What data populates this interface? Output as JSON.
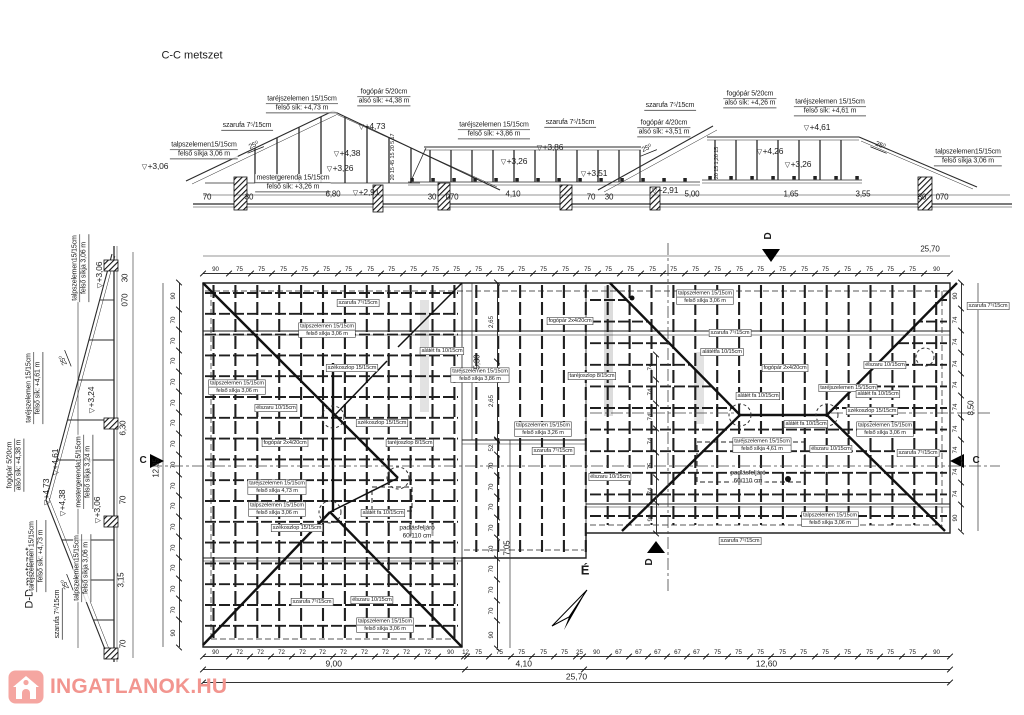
{
  "titles": {
    "section_cc": "C-C metszet",
    "section_dd": "D-D metszet"
  },
  "watermark": {
    "text": "INGATLANOK.HU",
    "color": "#f2958f",
    "icon_bg": "#f5a6a1"
  },
  "north": {
    "label": "É"
  },
  "annotations": [
    {
      "s": "title",
      "t": "C-C metszet",
      "x": 192,
      "y": 56
    },
    {
      "s": "title",
      "t": "D-D metszet",
      "x": 30,
      "y": 578,
      "r": -90
    },
    {
      "s": "u2",
      "t": "taréjszelemen 15/15cm|felső sík: +4,73 m",
      "x": 302,
      "y": 104
    },
    {
      "s": "u2",
      "t": "fogópár 5/20cm|alsó sík: +4,38 m",
      "x": 384,
      "y": 97
    },
    {
      "s": "u1",
      "t": "szarufa 7⁵/15cm",
      "x": 247,
      "y": 126
    },
    {
      "s": "u2",
      "t": "talpszelemen15/15cm|felső síkja 3,06 m",
      "x": 204,
      "y": 150
    },
    {
      "s": "lv",
      "t": "+3,06",
      "x": 155,
      "y": 167
    },
    {
      "s": "lv",
      "t": "+4,73",
      "x": 372,
      "y": 127
    },
    {
      "s": "lv",
      "t": "+4,38",
      "x": 347,
      "y": 154
    },
    {
      "s": "lv",
      "t": "+3,26",
      "x": 340,
      "y": 169
    },
    {
      "s": "u2",
      "t": "mestergerenda 15/15cm|felső sík: +3,26 m",
      "x": 293,
      "y": 183
    },
    {
      "s": "deg",
      "t": "25⁰",
      "x": 254,
      "y": 146,
      "r": -22
    },
    {
      "s": "d",
      "t": "70",
      "x": 207,
      "y": 198
    },
    {
      "s": "d",
      "t": "30",
      "x": 249,
      "y": 198
    },
    {
      "s": "d",
      "t": "6,80",
      "x": 333,
      "y": 195
    },
    {
      "s": "lv",
      "t": "+2,91",
      "x": 366,
      "y": 193
    },
    {
      "s": "d",
      "t": "30",
      "x": 432,
      "y": 198
    },
    {
      "s": "d",
      "t": "070",
      "x": 452,
      "y": 198
    },
    {
      "s": "d",
      "t": "4,10",
      "x": 513,
      "y": 195
    },
    {
      "s": "d",
      "t": "70",
      "x": 591,
      "y": 198
    },
    {
      "s": "d",
      "t": "30",
      "x": 609,
      "y": 198
    },
    {
      "s": "lv",
      "t": "+2,91",
      "x": 665,
      "y": 191
    },
    {
      "s": "d",
      "t": "5,00",
      "x": 692,
      "y": 195
    },
    {
      "s": "d",
      "t": "1,65",
      "x": 791,
      "y": 195
    },
    {
      "s": "d",
      "t": "3,55",
      "x": 863,
      "y": 195
    },
    {
      "s": "d",
      "t": "30",
      "x": 922,
      "y": 198
    },
    {
      "s": "d",
      "t": "070",
      "x": 942,
      "y": 198
    },
    {
      "s": "u2",
      "t": "taréjszelemen 15/15cm|felső sík: +3,86 m",
      "x": 494,
      "y": 130
    },
    {
      "s": "u1",
      "t": "szarufa 7⁵/15cm",
      "x": 570,
      "y": 123
    },
    {
      "s": "lv",
      "t": "+3,86",
      "x": 550,
      "y": 148
    },
    {
      "s": "lv",
      "t": "+3,26",
      "x": 514,
      "y": 162
    },
    {
      "s": "u1",
      "t": "szarufa 7⁵/15cm",
      "x": 670,
      "y": 106
    },
    {
      "s": "u2",
      "t": "fogópár 4/20cm|alsó sík: +3,51 m",
      "x": 664,
      "y": 128
    },
    {
      "s": "deg",
      "t": "25⁰",
      "x": 647,
      "y": 149,
      "r": -22
    },
    {
      "s": "lv",
      "t": "+3,51",
      "x": 594,
      "y": 174
    },
    {
      "s": "u2",
      "t": "fogópár 5/20cm|alsó sík: +4,26 m",
      "x": 750,
      "y": 99
    },
    {
      "s": "u2",
      "t": "taréjszelemen 15/15cm|felső sík: +4,61 m",
      "x": 830,
      "y": 107
    },
    {
      "s": "lv",
      "t": "+4,61",
      "x": 817,
      "y": 128
    },
    {
      "s": "lv",
      "t": "+4,26",
      "x": 770,
      "y": 152
    },
    {
      "s": "lv",
      "t": "+3,26",
      "x": 798,
      "y": 165
    },
    {
      "s": "deg",
      "t": "25⁰",
      "x": 880,
      "y": 146,
      "r": 22
    },
    {
      "s": "u2",
      "t": "talpszelemen15/15cm|felső síkja 3,06 m",
      "x": 968,
      "y": 157
    },
    {
      "s": "dv5",
      "t": "20 15 45 15 20 5 17",
      "x": 393,
      "y": 157,
      "r": -90
    },
    {
      "s": "dv5",
      "t": "20 15 1,20 15",
      "x": 717,
      "y": 163,
      "r": -90
    },
    {
      "s": "u2",
      "t": "talpszelemen15/15cm|felső síkja 3,06 m",
      "x": 80,
      "y": 268,
      "r": -90
    },
    {
      "s": "lv",
      "t": "+3,06",
      "x": 100,
      "y": 275,
      "r": -90
    },
    {
      "s": "u2",
      "t": "taréjszelemen 15/15cm|felső sík: +4,61 m",
      "x": 34,
      "y": 388,
      "r": -90
    },
    {
      "s": "deg",
      "t": "25⁰",
      "x": 64,
      "y": 360,
      "r": -112
    },
    {
      "s": "lv",
      "t": "+4,61",
      "x": 56,
      "y": 462,
      "r": -90
    },
    {
      "s": "lv",
      "t": "+3,24",
      "x": 92,
      "y": 400,
      "r": -90
    },
    {
      "s": "u2",
      "t": "fogópár 5/20cm|alsó sík: +4,38 m",
      "x": 15,
      "y": 465,
      "r": -90
    },
    {
      "s": "lv",
      "t": "+4,73",
      "x": 47,
      "y": 492,
      "r": -90
    },
    {
      "s": "lv",
      "t": "+4,38",
      "x": 63,
      "y": 503,
      "r": -90
    },
    {
      "s": "u2",
      "t": "mestergerenda15/15cm|felső síkja 3,24 m",
      "x": 84,
      "y": 472,
      "r": -90
    },
    {
      "s": "lv",
      "t": "+3,06",
      "x": 98,
      "y": 510,
      "r": -90
    },
    {
      "s": "u2",
      "t": "taréjszelemen 15/15cm|felső sík: +4,73 m",
      "x": 37,
      "y": 556,
      "r": -90
    },
    {
      "s": "u2",
      "t": "talpszelemen15/15cm|felső síkja 3,06 m",
      "x": 82,
      "y": 568,
      "r": -90
    },
    {
      "s": "u1",
      "t": "szarufa 7⁵/15cm",
      "x": 58,
      "y": 614,
      "r": -90
    },
    {
      "s": "deg",
      "t": "25⁰",
      "x": 66,
      "y": 584,
      "r": -112
    },
    {
      "s": "dv",
      "t": "30",
      "x": 126,
      "y": 278,
      "r": -90
    },
    {
      "s": "dv",
      "t": "070",
      "x": 126,
      "y": 300,
      "r": -90
    },
    {
      "s": "dv",
      "t": "6,30",
      "x": 124,
      "y": 428,
      "r": -90
    },
    {
      "s": "dv",
      "t": "70",
      "x": 124,
      "y": 500,
      "r": -90
    },
    {
      "s": "dv",
      "t": "3,15",
      "x": 122,
      "y": 580,
      "r": -90
    },
    {
      "s": "dv",
      "t": "70",
      "x": 124,
      "y": 644,
      "r": -90
    },
    {
      "s": "b",
      "t": "szarufa 7⁵/15cm",
      "x": 358,
      "y": 303
    },
    {
      "s": "b2",
      "t": "talpszelemen 15/15cm|felső síkja 3,06 m",
      "x": 327,
      "y": 330
    },
    {
      "s": "b",
      "t": "székoszlop 15/15cm",
      "x": 352,
      "y": 368
    },
    {
      "s": "b",
      "t": "alátét fa 10/15cm",
      "x": 442,
      "y": 351
    },
    {
      "s": "b2",
      "t": "talpszelemen 15/15cm|felső síkja 3,06 m",
      "x": 237,
      "y": 387
    },
    {
      "s": "b",
      "t": "élszaru 10/15cm",
      "x": 276,
      "y": 408
    },
    {
      "s": "b",
      "t": "székoszlop 15/15cm",
      "x": 382,
      "y": 423
    },
    {
      "s": "b",
      "t": "fogópár 2x4/20cm",
      "x": 285,
      "y": 443
    },
    {
      "s": "b",
      "t": "taréjoszlop 8/15cm",
      "x": 410,
      "y": 443
    },
    {
      "s": "b2",
      "t": "taréjszelemen 15/15cm|felső síkja 4,73 m",
      "x": 277,
      "y": 487
    },
    {
      "s": "b2",
      "t": "talpszelemen 15/15cm|felső síkja 3,06 m",
      "x": 277,
      "y": 509
    },
    {
      "s": "b",
      "t": "székoszlop 15/15cm",
      "x": 297,
      "y": 528
    },
    {
      "s": "b",
      "t": "alátét fa 10/15cm",
      "x": 383,
      "y": 513
    },
    {
      "s": "p2",
      "t": "padlásfeljáró|60/110 cm",
      "x": 417,
      "y": 532
    },
    {
      "s": "b",
      "t": "szarufa 7⁵/15cm",
      "x": 312,
      "y": 602
    },
    {
      "s": "b",
      "t": "élszaru 10/15cm",
      "x": 372,
      "y": 600
    },
    {
      "s": "b2",
      "t": "talpszelemen 15/15cm|felső síkja 3,06 m",
      "x": 385,
      "y": 625
    },
    {
      "s": "b2",
      "t": "talpszelemen 15/15cm|felső síkja 3,06 m",
      "x": 705,
      "y": 297
    },
    {
      "s": "b",
      "t": "fogópár 2x4/20cm",
      "x": 570,
      "y": 321
    },
    {
      "s": "b",
      "t": "szarufa 7⁵/15cm",
      "x": 730,
      "y": 333
    },
    {
      "s": "b",
      "t": "alátétfa 10/15cm",
      "x": 722,
      "y": 352
    },
    {
      "s": "b2",
      "t": "taréjszelemen 15/15cm|felső síkja 3,86 m",
      "x": 480,
      "y": 375
    },
    {
      "s": "b",
      "t": "taréjoszlop 8/15cm",
      "x": 592,
      "y": 376
    },
    {
      "s": "b2",
      "t": "talpszelemen 15/15cm|felső síkja 3,26 m",
      "x": 543,
      "y": 429
    },
    {
      "s": "b",
      "t": "szarufa 7⁵/15cm",
      "x": 553,
      "y": 451
    },
    {
      "s": "b",
      "t": "élszaru 10/15cm",
      "x": 885,
      "y": 365
    },
    {
      "s": "b",
      "t": "fogópár 2x4/20cm",
      "x": 785,
      "y": 368
    },
    {
      "s": "b",
      "t": "taréjszelemen 15/15cm",
      "x": 848,
      "y": 388
    },
    {
      "s": "b",
      "t": "alátét fa 10/15cm",
      "x": 758,
      "y": 396
    },
    {
      "s": "b",
      "t": "alátét fa 10/15cm",
      "x": 878,
      "y": 394
    },
    {
      "s": "b",
      "t": "székoszlop 15/15cm",
      "x": 872,
      "y": 411
    },
    {
      "s": "b",
      "t": "alátét fa 10/15cm",
      "x": 806,
      "y": 424
    },
    {
      "s": "b2",
      "t": "talpszelemen 15/15cm|felső síkja 3,06 m",
      "x": 885,
      "y": 429
    },
    {
      "s": "b",
      "t": "élszaru 10/15cm",
      "x": 831,
      "y": 449
    },
    {
      "s": "b",
      "t": "szarufa 7⁵/15cm",
      "x": 918,
      "y": 453
    },
    {
      "s": "b",
      "t": "szarufa 7⁵/15cm",
      "x": 988,
      "y": 306
    },
    {
      "s": "b2",
      "t": "taréjszelemen 15/15cm|felső síkja 4,61 m",
      "x": 762,
      "y": 445
    },
    {
      "s": "b",
      "t": "élszaru 10/15cm",
      "x": 610,
      "y": 477
    },
    {
      "s": "p2",
      "t": "padlásfeljáró|60/110 cm",
      "x": 748,
      "y": 477
    },
    {
      "s": "b",
      "t": "szarufa 7⁵/15cm",
      "x": 740,
      "y": 541
    },
    {
      "s": "b2",
      "t": "talpszelemen 15/15cm|felső síkja 3,06 m",
      "x": 830,
      "y": 519
    },
    {
      "s": "mk",
      "t": "C",
      "x": 143,
      "y": 461
    },
    {
      "s": "mk",
      "t": "C",
      "x": 976,
      "y": 461
    },
    {
      "s": "mk",
      "t": "D",
      "x": 769,
      "y": 236,
      "r": -90
    },
    {
      "s": "mk",
      "t": "D",
      "x": 650,
      "y": 562,
      "r": -90
    },
    {
      "s": "north",
      "t": "É",
      "x": 585,
      "y": 572
    },
    {
      "s": "d",
      "t": "25,70",
      "x": 930,
      "y": 250
    },
    {
      "s": "dv",
      "t": "12,35",
      "x": 157,
      "y": 468,
      "r": -90
    },
    {
      "s": "dv",
      "t": "8,50",
      "x": 972,
      "y": 408,
      "r": -90
    },
    {
      "s": "dv",
      "t": "7,05",
      "x": 508,
      "y": 548,
      "r": -90
    },
    {
      "s": "dv",
      "t": "5,30",
      "x": 478,
      "y": 362,
      "r": -90
    }
  ],
  "chains": [
    {
      "dir": "h",
      "x": 203,
      "y": 262,
      "len": 747,
      "v": [
        "90",
        "75",
        "75",
        "75",
        "75",
        "75",
        "75",
        "75",
        "75",
        "75",
        "75",
        "75",
        "75",
        "75",
        "75",
        "75",
        "75",
        "75",
        "75",
        "75",
        "75",
        "75",
        "75",
        "75",
        "75",
        "75",
        "75",
        "75",
        "75",
        "75",
        "75",
        "75",
        "75",
        "90"
      ]
    },
    {
      "dir": "h",
      "x": 203,
      "y": 645,
      "len": 747,
      "v": [
        "90",
        "72",
        "72",
        "72",
        "72",
        "72",
        "72",
        "72",
        "72",
        "72",
        "72",
        "90",
        "12",
        "75",
        "75",
        "75",
        "75",
        "75",
        "25",
        "90",
        "67",
        "67",
        "67",
        "67",
        "67",
        "75",
        "75",
        "75",
        "75",
        "75",
        "75",
        "75",
        "75",
        "75",
        "75",
        "90"
      ]
    },
    {
      "dir": "h",
      "x": 203,
      "y": 658,
      "len": 747,
      "fs": 0.85,
      "v": [
        "9,00",
        "4,10",
        "12,60"
      ]
    },
    {
      "dir": "h",
      "x": 203,
      "y": 671,
      "len": 747,
      "fs": 0.85,
      "v": [
        "25,70"
      ]
    },
    {
      "dir": "v",
      "x": 168,
      "y": 283,
      "len": 364,
      "v": [
        "90",
        "70",
        "70",
        "70",
        "70",
        "70",
        "70",
        "70",
        "70",
        "70",
        "70",
        "70",
        "70",
        "70",
        "70",
        "70",
        "90"
      ]
    },
    {
      "dir": "v",
      "x": 950,
      "y": 283,
      "len": 248,
      "v": [
        "90",
        "74",
        "74",
        "74",
        "74",
        "74",
        "74",
        "74",
        "74",
        "74",
        "90"
      ]
    },
    {
      "dir": "v",
      "x": 486,
      "y": 440,
      "len": 208,
      "v": [
        "52",
        "70",
        "70",
        "70",
        "70",
        "70",
        "70",
        "70",
        "70",
        "90"
      ]
    },
    {
      "dir": "v",
      "x": 486,
      "y": 283,
      "len": 157,
      "v": [
        "2,65",
        "2,65"
      ]
    },
    {
      "dir": "v",
      "x": 645,
      "y": 355,
      "len": 178,
      "v": [
        "74",
        "74",
        "74",
        "74",
        "75",
        "74",
        "90"
      ]
    }
  ]
}
